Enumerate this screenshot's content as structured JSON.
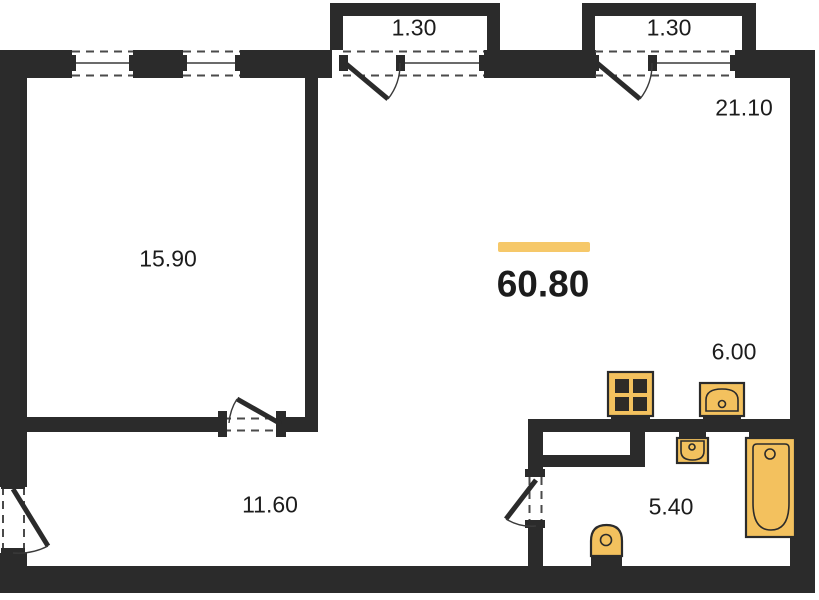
{
  "colors": {
    "wall": "#2b2b2b",
    "line": "#3a3a3a",
    "dash": "#4a4a4a",
    "fixture_fill": "#f3c15e",
    "accent_bar": "#f6c869",
    "text": "#1c1c1c"
  },
  "total": {
    "value": "60.80"
  },
  "rooms": [
    {
      "name": "bedroom",
      "area": "15.90"
    },
    {
      "name": "living-kitchen",
      "area": "21.10"
    },
    {
      "name": "hallway",
      "area": "11.60"
    },
    {
      "name": "kitchen-zone",
      "area": "6.00"
    },
    {
      "name": "bathroom",
      "area": "5.40"
    },
    {
      "name": "balcony-left",
      "area": "1.30"
    },
    {
      "name": "balcony-right",
      "area": "1.30"
    }
  ],
  "fixtures": [
    {
      "name": "stove"
    },
    {
      "name": "kitchen-sink"
    },
    {
      "name": "wash-basin"
    },
    {
      "name": "bathtub"
    },
    {
      "name": "toilet"
    }
  ]
}
